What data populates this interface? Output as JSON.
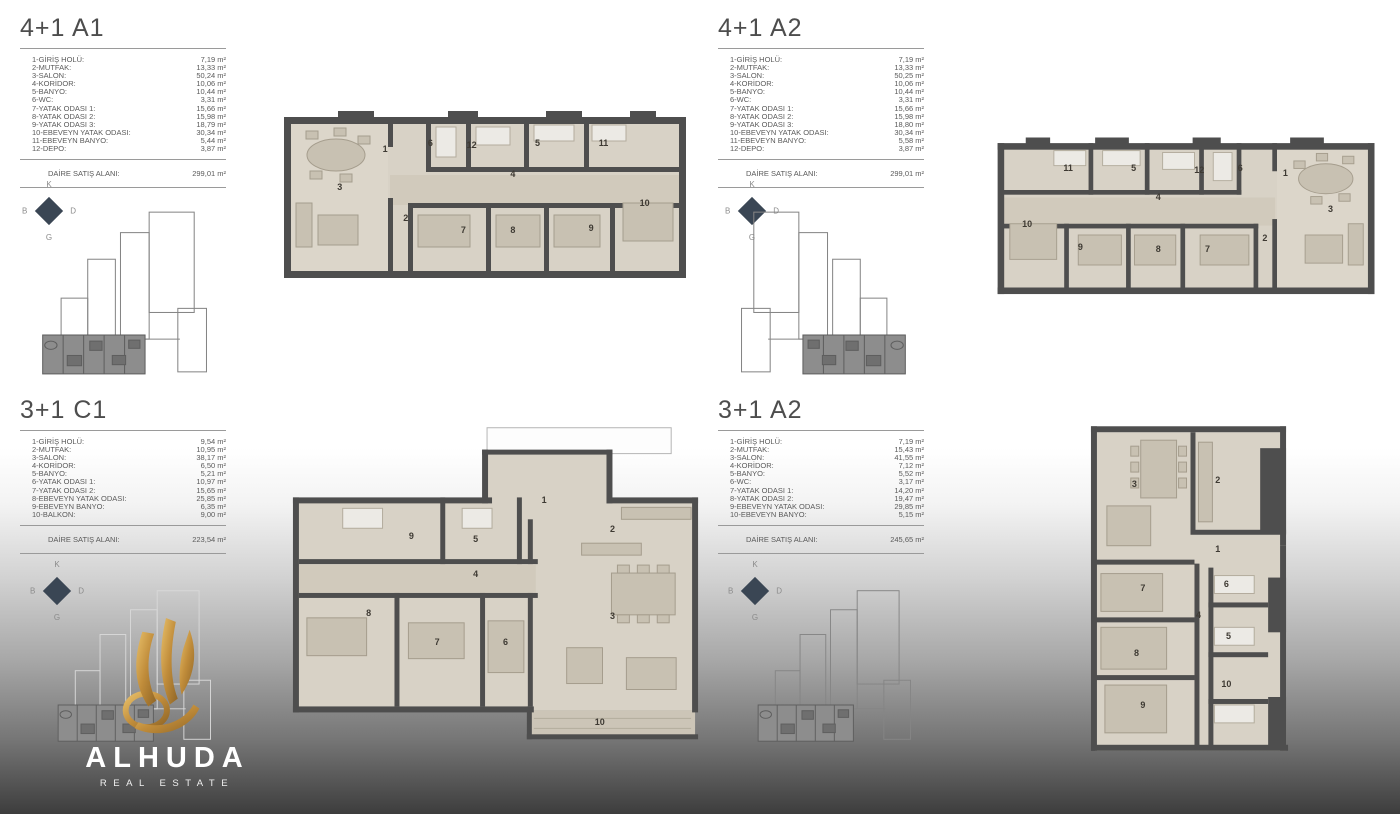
{
  "brand": {
    "name": "ALHUDA",
    "tagline": "REAL ESTATE"
  },
  "compass": {
    "n": "K",
    "e": "D",
    "s": "G",
    "w": "B"
  },
  "units": [
    {
      "id": "4+1-A1",
      "title": "4+1 A1",
      "rooms": [
        {
          "label": "1-GİRİŞ HOLÜ:",
          "value": "7,19 m²"
        },
        {
          "label": "2-MUTFAK:",
          "value": "13,33 m²"
        },
        {
          "label": "3-SALON:",
          "value": "50,24 m²"
        },
        {
          "label": "4-KORİDOR:",
          "value": "10,06 m²"
        },
        {
          "label": "5-BANYO:",
          "value": "10,44 m²"
        },
        {
          "label": "6-WC:",
          "value": "3,31 m²"
        },
        {
          "label": "7-YATAK ODASI 1:",
          "value": "15,66 m²"
        },
        {
          "label": "8-YATAK ODASI 2:",
          "value": "15,98 m²"
        },
        {
          "label": "9-YATAK ODASI 3:",
          "value": "18,79 m²"
        },
        {
          "label": "10-EBEVEYN YATAK ODASI:",
          "value": "30,34 m²"
        },
        {
          "label": "11-EBEVEYN BANYO:",
          "value": "5,44 m²"
        },
        {
          "label": "12-DEPO:",
          "value": "3,87 m²"
        }
      ],
      "total_label": "DAİRE SATIŞ ALANI:",
      "total_value": "299,01 m²",
      "plan_rooms": [
        {
          "n": "1",
          "x": 26,
          "y": 24
        },
        {
          "n": "6",
          "x": 37,
          "y": 21
        },
        {
          "n": "12",
          "x": 47,
          "y": 22
        },
        {
          "n": "5",
          "x": 63,
          "y": 21
        },
        {
          "n": "11",
          "x": 79,
          "y": 21
        },
        {
          "n": "3",
          "x": 15,
          "y": 44
        },
        {
          "n": "2",
          "x": 31,
          "y": 60
        },
        {
          "n": "4",
          "x": 57,
          "y": 37
        },
        {
          "n": "7",
          "x": 45,
          "y": 66
        },
        {
          "n": "8",
          "x": 57,
          "y": 66
        },
        {
          "n": "9",
          "x": 76,
          "y": 65
        },
        {
          "n": "10",
          "x": 89,
          "y": 52
        }
      ]
    },
    {
      "id": "4+1-A2",
      "title": "4+1 A2",
      "rooms": [
        {
          "label": "1-GİRİŞ HOLÜ:",
          "value": "7,19 m²"
        },
        {
          "label": "2-MUTFAK:",
          "value": "13,33 m²"
        },
        {
          "label": "3-SALON:",
          "value": "50,25 m²"
        },
        {
          "label": "4-KORİDOR:",
          "value": "10,06 m²"
        },
        {
          "label": "5-BANYO:",
          "value": "10,44 m²"
        },
        {
          "label": "6-WC:",
          "value": "3,31 m²"
        },
        {
          "label": "7-YATAK ODASI 1:",
          "value": "15,66 m²"
        },
        {
          "label": "8-YATAK ODASI 2:",
          "value": "15,98 m²"
        },
        {
          "label": "9-YATAK ODASI 3:",
          "value": "18,80 m²"
        },
        {
          "label": "10-EBEVEYN YATAK ODASI:",
          "value": "30,34 m²"
        },
        {
          "label": "11-EBEVEYN BANYO:",
          "value": "5,58 m²"
        },
        {
          "label": "12-DEPO:",
          "value": "3,87 m²"
        }
      ],
      "total_label": "DAİRE SATIŞ ALANI:",
      "total_value": "299,01 m²",
      "plan_rooms": [
        {
          "n": "1",
          "x": 74,
          "y": 24
        },
        {
          "n": "6",
          "x": 63,
          "y": 21
        },
        {
          "n": "12",
          "x": 53,
          "y": 22
        },
        {
          "n": "5",
          "x": 37,
          "y": 21
        },
        {
          "n": "11",
          "x": 21,
          "y": 21
        },
        {
          "n": "3",
          "x": 85,
          "y": 44
        },
        {
          "n": "2",
          "x": 69,
          "y": 60
        },
        {
          "n": "4",
          "x": 43,
          "y": 37
        },
        {
          "n": "7",
          "x": 55,
          "y": 66
        },
        {
          "n": "8",
          "x": 43,
          "y": 66
        },
        {
          "n": "9",
          "x": 24,
          "y": 65
        },
        {
          "n": "10",
          "x": 11,
          "y": 52
        }
      ]
    },
    {
      "id": "3+1-C1",
      "title": "3+1 C1",
      "rooms": [
        {
          "label": "1-GİRİŞ HOLÜ:",
          "value": "9,54 m²"
        },
        {
          "label": "2-MUTFAK:",
          "value": "10,95 m²"
        },
        {
          "label": "3-SALON:",
          "value": "38,17 m²"
        },
        {
          "label": "4-KORİDOR:",
          "value": "6,50 m²"
        },
        {
          "label": "5-BANYO:",
          "value": "5,21 m²"
        },
        {
          "label": "6-YATAK ODASI 1:",
          "value": "10,97 m²"
        },
        {
          "label": "7-YATAK ODASI 2:",
          "value": "15,65 m²"
        },
        {
          "label": "8-EBEVEYN YATAK ODASI:",
          "value": "25,85 m²"
        },
        {
          "label": "9-EBEVEYN BANYO:",
          "value": "6,35 m²"
        },
        {
          "label": "10-BALKON:",
          "value": "9,00 m²"
        }
      ],
      "total_label": "DAİRE SATIŞ ALANI:",
      "total_value": "223,54 m²",
      "plan_rooms": [
        {
          "n": "1",
          "x": 61,
          "y": 24
        },
        {
          "n": "9",
          "x": 30,
          "y": 35
        },
        {
          "n": "5",
          "x": 45,
          "y": 36
        },
        {
          "n": "4",
          "x": 45,
          "y": 47
        },
        {
          "n": "2",
          "x": 77,
          "y": 33
        },
        {
          "n": "3",
          "x": 77,
          "y": 60
        },
        {
          "n": "8",
          "x": 20,
          "y": 59
        },
        {
          "n": "7",
          "x": 36,
          "y": 68
        },
        {
          "n": "6",
          "x": 52,
          "y": 68
        },
        {
          "n": "10",
          "x": 74,
          "y": 93
        }
      ]
    },
    {
      "id": "3+1-A2",
      "title": "3+1 A2",
      "rooms": [
        {
          "label": "1-GİRİŞ HOLÜ:",
          "value": "7,19 m²"
        },
        {
          "label": "2-MUTFAK:",
          "value": "15,43 m²"
        },
        {
          "label": "3-SALON:",
          "value": "41,55 m²"
        },
        {
          "label": "4-KORİDOR:",
          "value": "7,12 m²"
        },
        {
          "label": "5-BANYO:",
          "value": "5,52 m²"
        },
        {
          "label": "6-WC:",
          "value": "3,17 m²"
        },
        {
          "label": "7-YATAK ODASI 1:",
          "value": "14,20 m²"
        },
        {
          "label": "8-YATAK ODASI 2:",
          "value": "19,47 m²"
        },
        {
          "label": "9-EBEVEYN YATAK ODASI:",
          "value": "29,85 m²"
        },
        {
          "label": "10-EBEVEYN BANYO:",
          "value": "5,15 m²"
        }
      ],
      "total_label": "DAİRE SATIŞ ALANI:",
      "total_value": "245,65 m²",
      "plan_rooms": [
        {
          "n": "3",
          "x": 24,
          "y": 19
        },
        {
          "n": "2",
          "x": 63,
          "y": 18
        },
        {
          "n": "1",
          "x": 63,
          "y": 38
        },
        {
          "n": "7",
          "x": 28,
          "y": 49
        },
        {
          "n": "6",
          "x": 67,
          "y": 48
        },
        {
          "n": "4",
          "x": 54,
          "y": 57
        },
        {
          "n": "5",
          "x": 68,
          "y": 63
        },
        {
          "n": "8",
          "x": 25,
          "y": 68
        },
        {
          "n": "10",
          "x": 67,
          "y": 77
        },
        {
          "n": "9",
          "x": 28,
          "y": 83
        }
      ]
    }
  ]
}
